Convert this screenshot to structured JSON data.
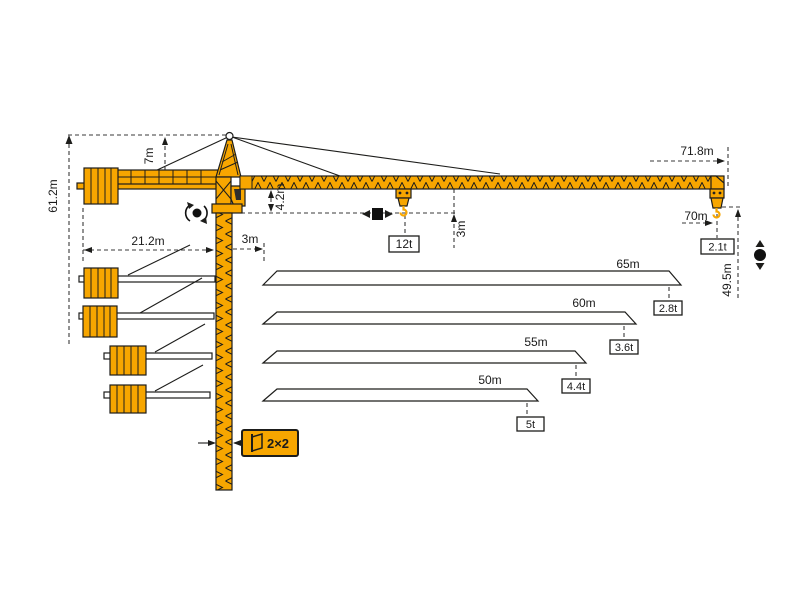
{
  "diagram_type": "tower-crane-load-and-dimension-diagram",
  "colors": {
    "crane_orange": "#F7A600",
    "outline_black": "#1d1d1b",
    "dash_gray": "#3a3a3a",
    "background": "#ffffff"
  },
  "dims": {
    "total_height": "61.2m",
    "tower_top_height": "7m",
    "counterjib_radius": "21.2m",
    "counterjib_clearance": "3m",
    "jib_root_height": "4.2m",
    "hook_clearance": "3m",
    "max_capacity": "12t",
    "overall_length": "71.8m",
    "max_radius": "70m",
    "tip_capacity": "2.1t",
    "hook_height": "49.5m",
    "mast_section": "2×2"
  },
  "variants": [
    {
      "length": "65m",
      "capacity": "2.8t"
    },
    {
      "length": "60m",
      "capacity": "3.6t"
    },
    {
      "length": "55m",
      "capacity": "4.4t"
    },
    {
      "length": "50m",
      "capacity": "5t"
    }
  ],
  "icons": {
    "slewing": "slewing-rotation-icon",
    "trolley": "trolley-travel-icon",
    "hoist": "hoisting-icon",
    "mast_section": "mast-cross-section-icon"
  }
}
